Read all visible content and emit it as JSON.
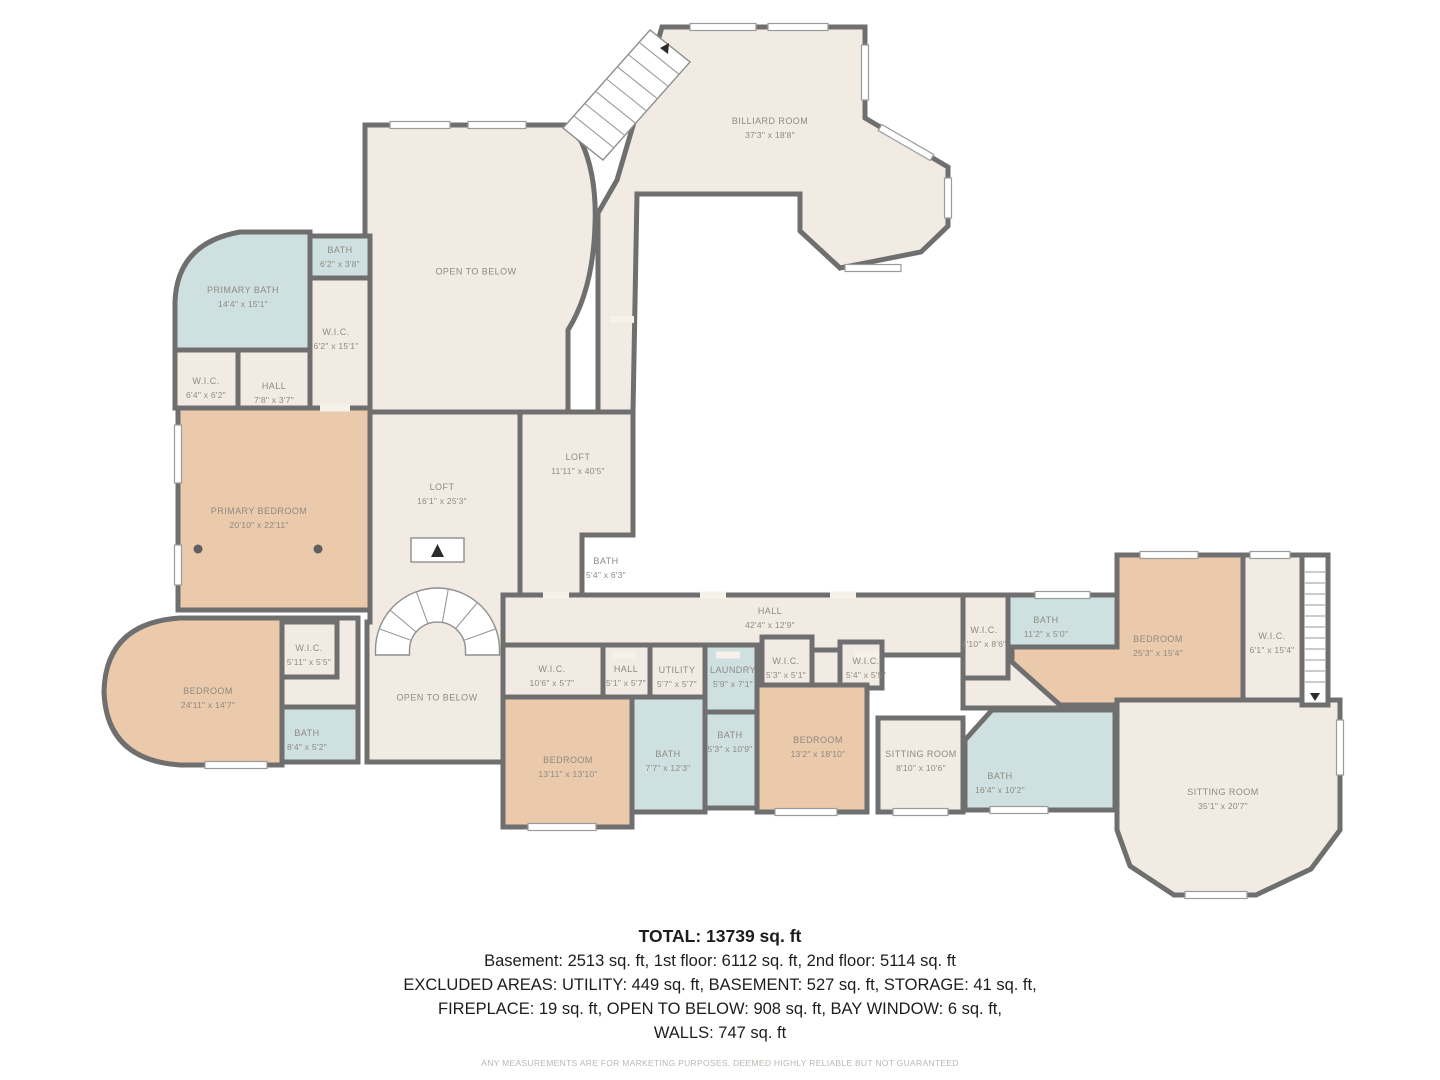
{
  "plan": {
    "rooms": [
      {
        "name": "BILLIARD ROOM",
        "dims": "37'3\" x 18'8\""
      },
      {
        "name": "OPEN TO BELOW",
        "dims": ""
      },
      {
        "name": "BATH",
        "dims": "6'2\" x 3'8\""
      },
      {
        "name": "PRIMARY BATH",
        "dims": "14'4\" x 15'1\""
      },
      {
        "name": "W.I.C.",
        "dims": "6'2\" x 15'1\""
      },
      {
        "name": "W.I.C.",
        "dims": "6'4\" x 6'2\""
      },
      {
        "name": "HALL",
        "dims": "7'8\" x 3'7\""
      },
      {
        "name": "PRIMARY BEDROOM",
        "dims": "20'10\" x 22'11\""
      },
      {
        "name": "LOFT",
        "dims": "16'1\" x 25'3\""
      },
      {
        "name": "LOFT",
        "dims": "11'11\" x 40'5\""
      },
      {
        "name": "BATH",
        "dims": "5'4\" x 6'3\""
      },
      {
        "name": "HALL",
        "dims": "42'4\" x 12'9\""
      },
      {
        "name": "W.I.C.",
        "dims": "5'11\" x 5'5\""
      },
      {
        "name": "BEDROOM",
        "dims": "24'11\" x 14'7\""
      },
      {
        "name": "BATH",
        "dims": "8'4\" x 5'2\""
      },
      {
        "name": "OPEN TO BELOW",
        "dims": ""
      },
      {
        "name": "W.I.C.",
        "dims": "10'6\" x 5'7\""
      },
      {
        "name": "HALL",
        "dims": "5'1\" x 5'7\""
      },
      {
        "name": "UTILITY",
        "dims": "5'7\" x 5'7\""
      },
      {
        "name": "LAUNDRY",
        "dims": "5'9\" x 7'1\""
      },
      {
        "name": "W.I.C.",
        "dims": "5'3\" x 5'1\""
      },
      {
        "name": "W.I.C.",
        "dims": "5'4\" x 5'5\""
      },
      {
        "name": "BEDROOM",
        "dims": "13'11\" x 13'10\""
      },
      {
        "name": "BATH",
        "dims": "7'7\" x 12'3\""
      },
      {
        "name": "BATH",
        "dims": "5'3\" x 10'9\""
      },
      {
        "name": "BEDROOM",
        "dims": "13'2\" x 18'10\""
      },
      {
        "name": "SITTING ROOM",
        "dims": "8'10\" x 10'6\""
      },
      {
        "name": "BATH",
        "dims": "16'4\" x 10'2\""
      },
      {
        "name": "W.I.C.",
        "dims": "4'10\" x 8'6\""
      },
      {
        "name": "BATH",
        "dims": "11'2\" x 5'0\""
      },
      {
        "name": "BEDROOM",
        "dims": "25'3\" x 15'4\""
      },
      {
        "name": "W.I.C.",
        "dims": "6'1\" x 15'4\""
      },
      {
        "name": "SITTING ROOM",
        "dims": "35'1\" x 20'7\""
      }
    ],
    "colors": {
      "floor": "#f2ebe4",
      "bedroom": "#ebc9ab",
      "bath": "#cfe0e0",
      "wall": "#6f6f6f",
      "label_text": "#8d8b83"
    }
  },
  "summary": {
    "total": "TOTAL: 13739 sq. ft",
    "line1": "Basement: 2513 sq. ft, 1st floor: 6112 sq. ft, 2nd floor: 5114 sq. ft",
    "line2": "EXCLUDED AREAS: UTILITY: 449 sq. ft, BASEMENT: 527 sq. ft, STORAGE: 41 sq. ft,",
    "line3": "FIREPLACE: 19 sq. ft, OPEN TO BELOW: 908 sq. ft, BAY WINDOW: 6 sq. ft,",
    "line4": "WALLS: 747 sq. ft",
    "disclaimer": "ANY MEASUREMENTS ARE FOR MARKETING PURPOSES, DEEMED HIGHLY RELIABLE BUT NOT GUARANTEED"
  }
}
